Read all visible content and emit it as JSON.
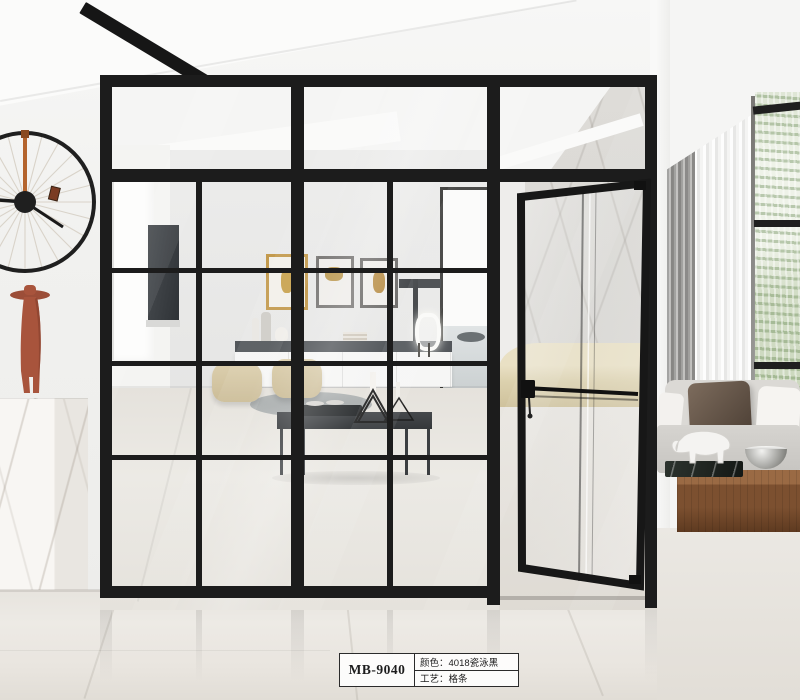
{
  "scene": {
    "type": "product-photo",
    "description": "Modern interior showcasing a black-framed grid glass partition wall with an open swing glass door, wheel wall clock, marble pedestal with terracotta figurine, and lounge visible through the glass",
    "product_label": {
      "model": "MB-9040",
      "rows": [
        {
          "field": "颜色",
          "value": "4018瓷泳黑",
          "text": "颜色：4018瓷泳黑"
        },
        {
          "field": "工艺",
          "value": "格条",
          "text": "工艺：格条"
        }
      ]
    },
    "colors": {
      "frame_black": "#1c1c1c",
      "wall_white": "#f1f1ef",
      "floor_marble": "#e9e6e1",
      "terracotta_figurine": "#a8543c",
      "clock_stem_copper": "#b4642d",
      "pouf_beige": "#d8c8a4",
      "bench_beige": "#ded3b4",
      "plant_green": "#a9c194",
      "wood_table_brown": "#7c5030",
      "pillow_brown": "#5e4c40"
    }
  }
}
